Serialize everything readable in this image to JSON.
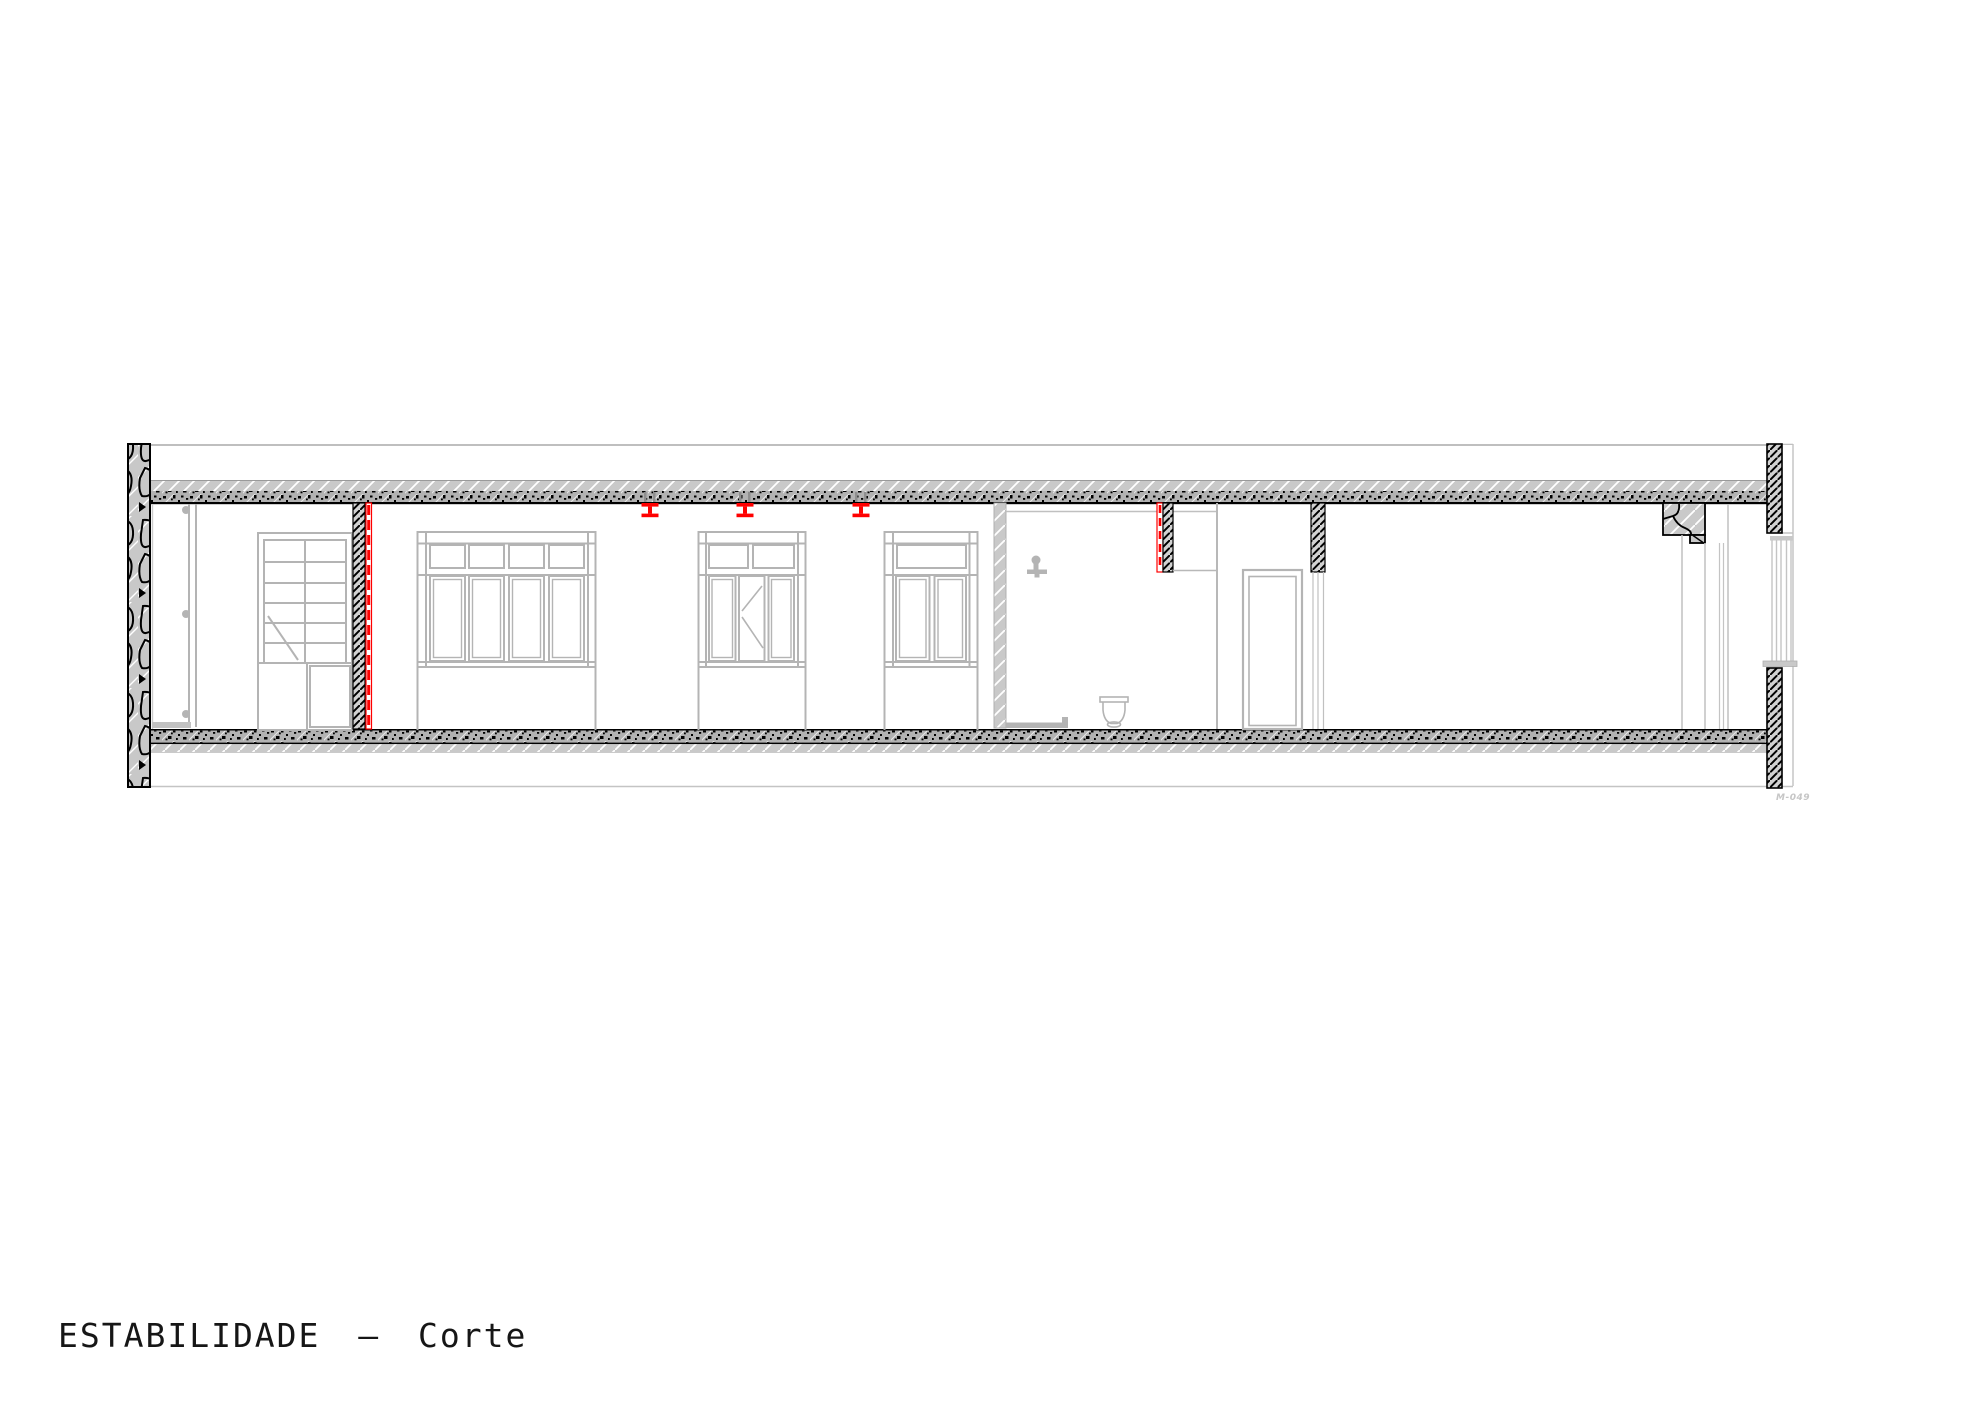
{
  "title": {
    "text": "ESTABILIDADE — Corte"
  },
  "ref_code": "M-049",
  "colors": {
    "background": "#FFFFFF",
    "highlight_red": "#FF0000",
    "linework_gray": "#B4B4B4",
    "section_fill_gray": "#C8C8C8",
    "speckle_fill_gray": "#B2B2B2",
    "ink_black": "#000000"
  },
  "drawing": {
    "type": "building longitudinal section",
    "highlighted_steel_beams": {
      "count": 3,
      "color": "#FF0000"
    },
    "highlighted_walls": {
      "count": 2,
      "color": "#FF0000"
    },
    "elements": [
      "roof-line",
      "left-exterior-stone-wall",
      "top-floor-slab",
      "bottom-floor-slab",
      "interior-door-leaf",
      "shelving-unit",
      "highlighted-partition-wall",
      "steel-beam-marker",
      "glazed-partition-1",
      "glazed-partition-2",
      "glazed-partition-3",
      "bathroom-plaster-partition",
      "shower-head-icon",
      "toilet-icon",
      "shower-curb",
      "highlighted-wall-lintel",
      "bathroom-door",
      "door-lintel-hatch",
      "stone-corbel",
      "chimney-lines",
      "right-exterior-wall",
      "right-window",
      "window-sill",
      "ground-line"
    ]
  }
}
